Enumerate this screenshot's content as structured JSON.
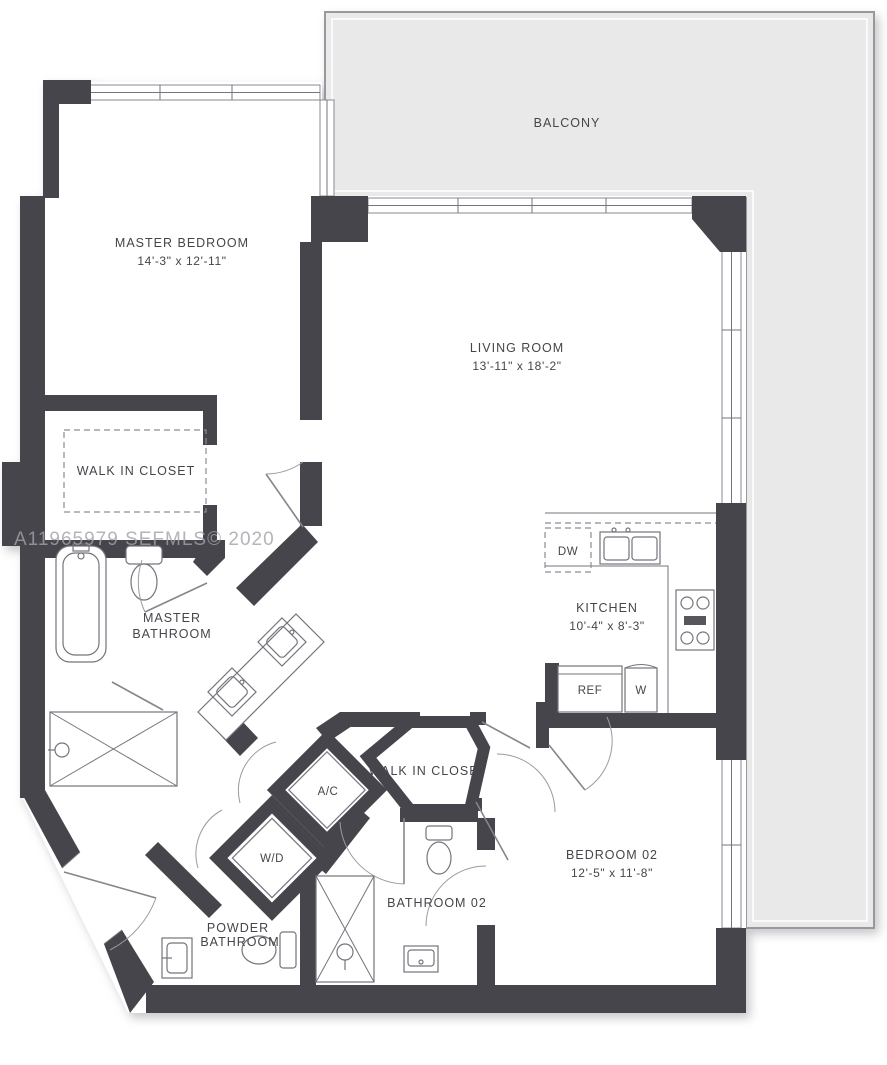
{
  "watermark": "A11965979 SEFMLS© 2020",
  "rooms": {
    "balcony": {
      "label": "BALCONY"
    },
    "master_bedroom": {
      "label": "MASTER BEDROOM",
      "dims": "14'-3\" x 12'-11\""
    },
    "living_room": {
      "label": "LIVING ROOM",
      "dims": "13'-11\" x 18'-2\""
    },
    "walk_in_closet_1": {
      "label": "WALK IN CLOSET"
    },
    "master_bathroom": {
      "line1": "MASTER",
      "line2": "BATHROOM"
    },
    "kitchen": {
      "label": "KITCHEN",
      "dims": "10'-4\" x 8'-3\""
    },
    "walk_in_closet_2": {
      "label": "WALK IN CLOSET"
    },
    "bedroom_02": {
      "label": "BEDROOM 02",
      "dims": "12'-5\" x 11'-8\""
    },
    "bathroom_02": {
      "label": "BATHROOM 02"
    },
    "powder_bathroom": {
      "line1": "POWDER",
      "line2": "BATHROOM"
    }
  },
  "appliances": {
    "dishwasher": "DW",
    "refrigerator": "REF",
    "washer": "W",
    "air_conditioner": "A/C",
    "washer_dryer": "W/D"
  },
  "colors": {
    "wall": "#45454b",
    "balcony_fill": "#e9e9ea",
    "balcony_border": "#98989e",
    "fixture_line": "#74747c",
    "text": "#45454b",
    "watermark": "#a2a2a8"
  }
}
